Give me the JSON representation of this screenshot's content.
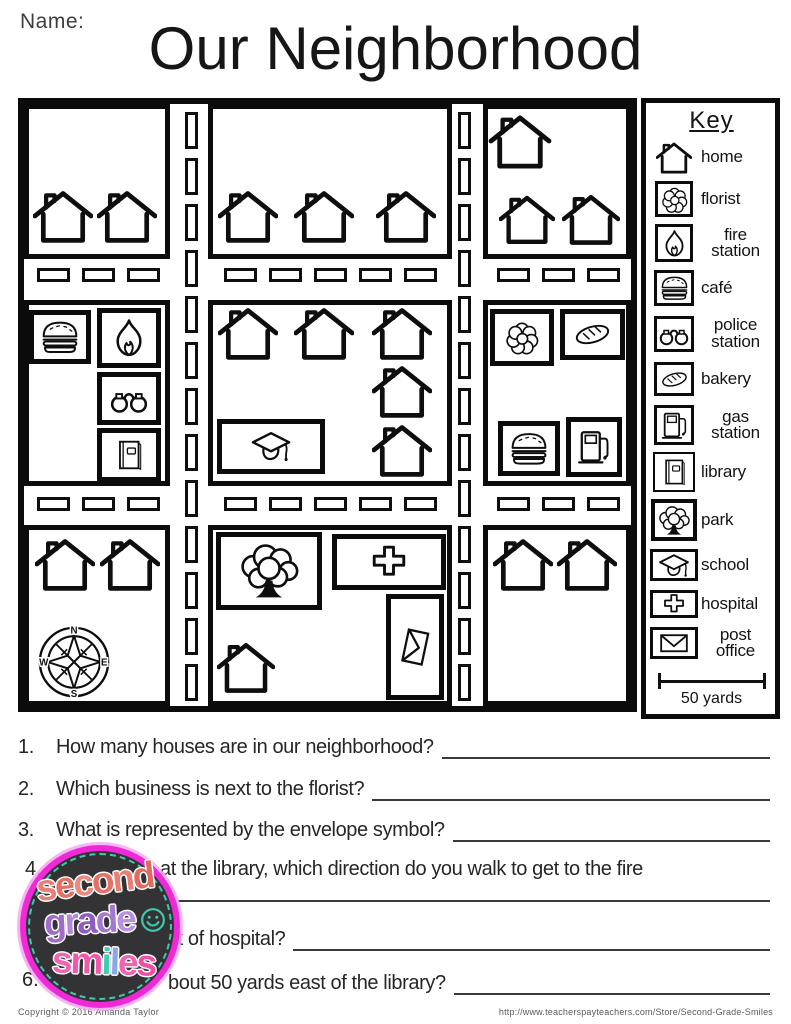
{
  "page": {
    "name_label": "Name:",
    "title": "Our Neighborhood"
  },
  "key": {
    "title": "Key",
    "scale_label": "50 yards",
    "items": [
      {
        "id": "home",
        "icon": "house",
        "label": "home",
        "box": "none"
      },
      {
        "id": "florist",
        "icon": "flower",
        "label": "florist",
        "box": "square"
      },
      {
        "id": "fire-station",
        "icon": "flame",
        "label": "fire station",
        "box": "square"
      },
      {
        "id": "cafe",
        "icon": "burger",
        "label": "café",
        "box": "square"
      },
      {
        "id": "police-station",
        "icon": "cuffs",
        "label": "police station",
        "box": "square"
      },
      {
        "id": "bakery",
        "icon": "bread",
        "label": "bakery",
        "box": "square"
      },
      {
        "id": "gas-station",
        "icon": "gaspump",
        "label": "gas station",
        "box": "square"
      },
      {
        "id": "library",
        "icon": "book",
        "label": "library",
        "box": "square"
      },
      {
        "id": "park",
        "icon": "tree",
        "label": "park",
        "box": "square"
      },
      {
        "id": "school",
        "icon": "gradcap",
        "label": "school",
        "box": "wide"
      },
      {
        "id": "hospital",
        "icon": "cross",
        "label": "hospital",
        "box": "wide"
      },
      {
        "id": "post-office",
        "icon": "envelope",
        "label": "post office",
        "box": "wide"
      }
    ]
  },
  "map": {
    "compass": {
      "north": "N",
      "east": "E",
      "south": "S",
      "west": "W"
    },
    "blocks": [
      {
        "id": "top-left",
        "x": 0,
        "y": 0,
        "w": 146,
        "h": 155,
        "items": [
          {
            "t": "house",
            "x": 9,
            "y": 84
          },
          {
            "t": "house",
            "x": 73,
            "y": 84
          }
        ]
      },
      {
        "id": "top-middle",
        "x": 184,
        "y": 0,
        "w": 244,
        "h": 155,
        "items": [
          {
            "t": "house",
            "x": 194,
            "y": 84
          },
          {
            "t": "house",
            "x": 270,
            "y": 84
          },
          {
            "t": "house",
            "x": 352,
            "y": 84
          }
        ]
      },
      {
        "id": "top-right",
        "x": 459,
        "y": 0,
        "w": 148,
        "h": 155,
        "items": [
          {
            "t": "house",
            "x": 464,
            "y": 9,
            "w": 64
          },
          {
            "t": "house",
            "x": 475,
            "y": 87,
            "w": 56
          },
          {
            "t": "house",
            "x": 538,
            "y": 87,
            "w": 58
          }
        ]
      },
      {
        "id": "middle-left",
        "x": 0,
        "y": 196,
        "w": 146,
        "h": 186,
        "items": [
          {
            "t": "box",
            "icon": "burger",
            "name": "cafe",
            "x": 5,
            "y": 206,
            "w": 62,
            "h": 54
          },
          {
            "t": "box",
            "icon": "flame",
            "name": "fire-station",
            "x": 73,
            "y": 204,
            "w": 64,
            "h": 60
          },
          {
            "t": "box",
            "icon": "cuffs",
            "name": "police-station",
            "x": 73,
            "y": 268,
            "w": 64,
            "h": 53
          },
          {
            "t": "box",
            "icon": "book",
            "name": "library",
            "x": 73,
            "y": 324,
            "w": 64,
            "h": 54
          }
        ]
      },
      {
        "id": "middle-center",
        "x": 184,
        "y": 196,
        "w": 244,
        "h": 186,
        "items": [
          {
            "t": "house",
            "x": 194,
            "y": 201
          },
          {
            "t": "house",
            "x": 270,
            "y": 201
          },
          {
            "t": "house",
            "x": 348,
            "y": 201
          },
          {
            "t": "house",
            "x": 348,
            "y": 259
          },
          {
            "t": "house",
            "x": 348,
            "y": 318
          },
          {
            "t": "box",
            "icon": "gradcap",
            "name": "school",
            "x": 193,
            "y": 315,
            "w": 108,
            "h": 55
          }
        ]
      },
      {
        "id": "middle-right",
        "x": 459,
        "y": 196,
        "w": 148,
        "h": 186,
        "items": [
          {
            "t": "box",
            "icon": "flower",
            "name": "florist",
            "x": 466,
            "y": 205,
            "w": 64,
            "h": 57
          },
          {
            "t": "box",
            "icon": "bread",
            "name": "bakery",
            "x": 536,
            "y": 205,
            "w": 65,
            "h": 51
          },
          {
            "t": "box",
            "icon": "burger",
            "name": "cafe",
            "x": 474,
            "y": 317,
            "w": 62,
            "h": 55
          },
          {
            "t": "box",
            "icon": "gaspump",
            "name": "gas-station",
            "x": 542,
            "y": 313,
            "w": 56,
            "h": 60
          }
        ]
      },
      {
        "id": "bottom-left",
        "x": 0,
        "y": 421,
        "w": 146,
        "h": 181,
        "items": [
          {
            "t": "house",
            "x": 11,
            "y": 432
          },
          {
            "t": "house",
            "x": 76,
            "y": 432
          },
          {
            "t": "compass",
            "x": 11,
            "y": 519,
            "w": 78,
            "h": 78
          }
        ]
      },
      {
        "id": "bottom-middle",
        "x": 184,
        "y": 421,
        "w": 244,
        "h": 181,
        "items": [
          {
            "t": "box",
            "icon": "tree",
            "name": "park",
            "x": 192,
            "y": 428,
            "w": 106,
            "h": 78
          },
          {
            "t": "box",
            "icon": "cross",
            "name": "hospital",
            "x": 308,
            "y": 430,
            "w": 114,
            "h": 56
          },
          {
            "t": "post",
            "icon": "envelope",
            "name": "post-office",
            "x": 362,
            "y": 490,
            "w": 58,
            "h": 106
          },
          {
            "t": "house",
            "x": 193,
            "y": 533,
            "w": 58,
            "h": 60
          }
        ]
      },
      {
        "id": "bottom-right",
        "x": 459,
        "y": 421,
        "w": 148,
        "h": 181,
        "items": [
          {
            "t": "house",
            "x": 469,
            "y": 432
          },
          {
            "t": "house",
            "x": 533,
            "y": 432
          }
        ]
      }
    ]
  },
  "questions": [
    {
      "num": "1.",
      "text": "How many houses are in our neighborhood?"
    },
    {
      "num": "2.",
      "text": "Which business is next to the florist?"
    },
    {
      "num": "3.",
      "text": "What is represented by the envelope symbol?"
    },
    {
      "num": "4.",
      "text": "at the library, which direction do you walk to get to the fire"
    },
    {
      "num": "",
      "text": "st of hospital?"
    },
    {
      "num": "6.",
      "text": "bout 50 yards east of the library?"
    }
  ],
  "logo": {
    "line1": "second",
    "line2": "grade",
    "line3": "smiles",
    "line1_colors": [
      "#e87f76",
      "#e57066",
      "#ea8a80",
      "#e57066",
      "#e87f76",
      "#e06a60"
    ],
    "line2_colors": [
      "#a06cc8",
      "#b287d8",
      "#8f5cc0",
      "#a578d0",
      "#b98fde"
    ],
    "line3_colors": [
      "#f263b2",
      "#ef58ab",
      "#3fcdb4",
      "#8ba6ea",
      "#f263b2",
      "#ee4fa5"
    ],
    "ring_color": "#ef29d8",
    "chalk_color": "#333335",
    "dash_color": "#3fc9af",
    "smiley_color": "#3fc9af"
  },
  "footer": {
    "left": "Copyright © 2016 Amanda Taylor",
    "right": "http://www.teacherspayteachers.com/Store/Second-Grade-Smiles"
  }
}
